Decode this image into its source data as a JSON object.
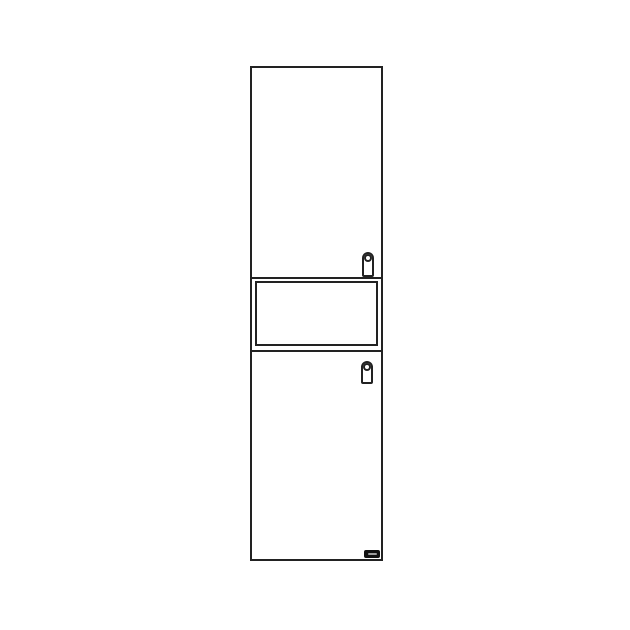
{
  "colors": {
    "background": "#ffffff",
    "line": "#222222",
    "label_background": "#111111",
    "label_mark": "#9e9e9e"
  },
  "icons": {
    "upper_handle": "door-handle-icon",
    "lower_handle": "door-handle-icon",
    "brand_label": "brand-logo-badge"
  }
}
